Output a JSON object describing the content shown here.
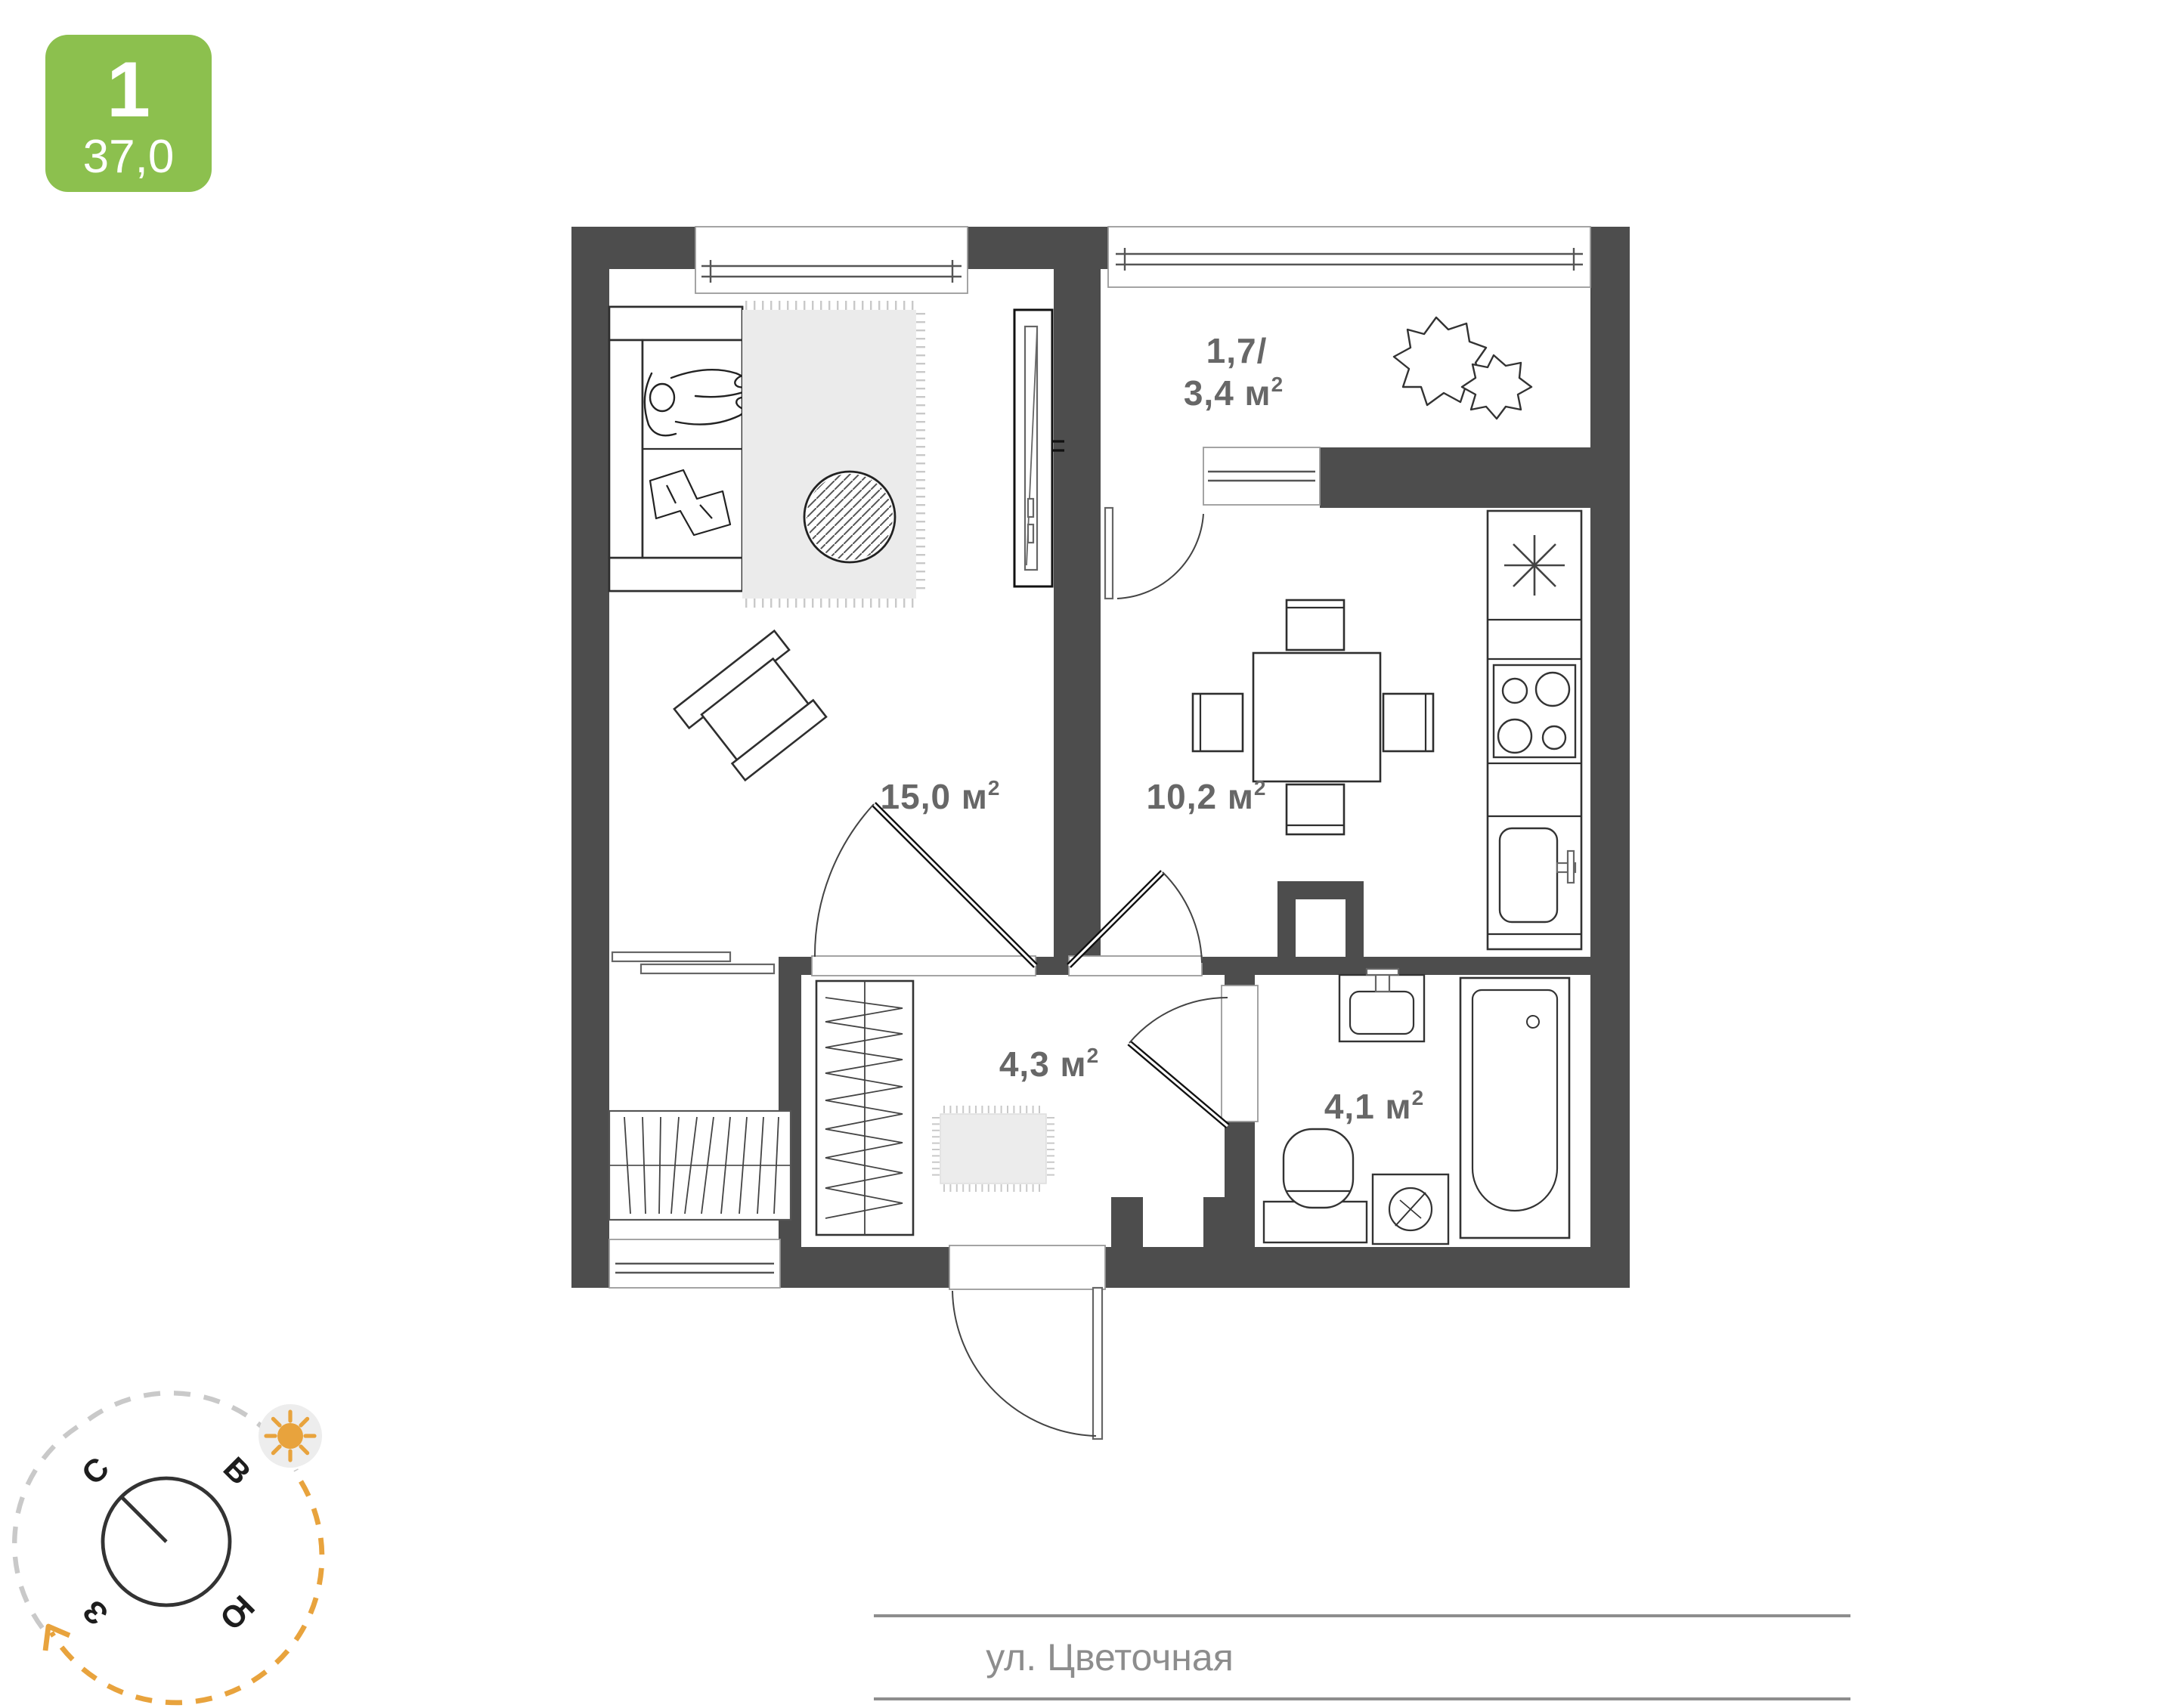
{
  "badge": {
    "rooms_count": "1",
    "total_area": "37,0"
  },
  "rooms": {
    "living": {
      "text": "15,0 м",
      "sup": "2"
    },
    "kitchen": {
      "text": "10,2 м",
      "sup": "2"
    },
    "hallway": {
      "text": "4,3 м",
      "sup": "2"
    },
    "bathroom": {
      "text": "4,1 м",
      "sup": "2"
    },
    "balcony": {
      "line1": "1,7/",
      "line2": "3,4 м",
      "sup": "2"
    }
  },
  "compass": {
    "north": "С",
    "east": "В",
    "south": "Ю",
    "west": "З"
  },
  "street": {
    "name": "ул. Цветочная"
  },
  "colors": {
    "wall": "#4d4d4d",
    "badge_green": "#8cc04e",
    "label_gray": "#676767",
    "street_gray": "#8d8d8d",
    "sun_orange": "#e8a33d",
    "rug_gray": "#ebebeb"
  },
  "icons": [
    "sofa",
    "person-on-sofa",
    "blanket",
    "area-rug",
    "pouf",
    "armchair",
    "tv-unit",
    "radiator",
    "console-shelf",
    "dining-table",
    "dining-chair",
    "refrigerator",
    "stove-burners",
    "kitchen-sink",
    "wardrobe-hangers",
    "doormat",
    "washbasin",
    "toilet",
    "washing-machine",
    "bathtub",
    "plant",
    "compass-rose",
    "sun",
    "entrance-door",
    "interior-door",
    "window"
  ]
}
